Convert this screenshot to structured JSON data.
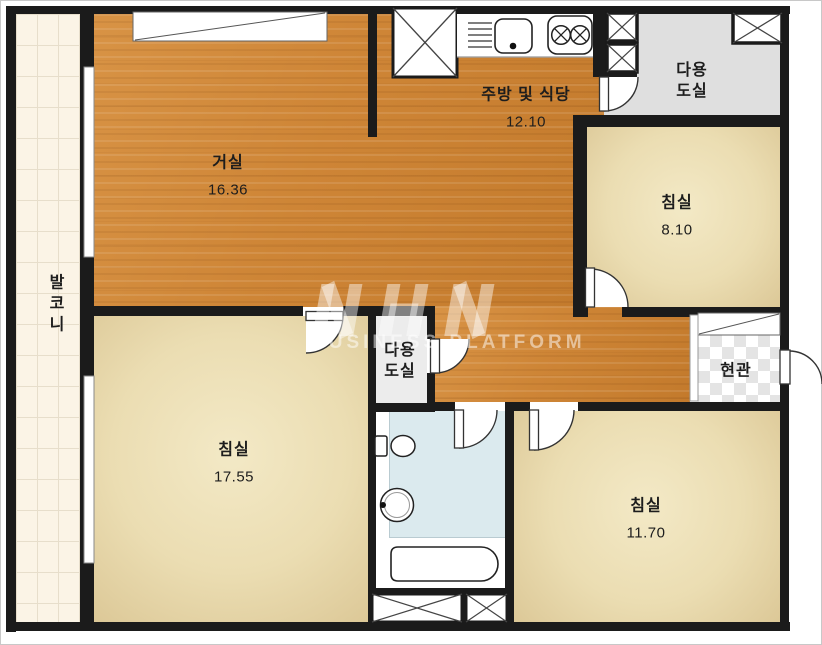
{
  "plan": {
    "type": "apartment-floor-plan",
    "rooms": {
      "living": {
        "name": "거실",
        "area": "16.36"
      },
      "kitchen": {
        "name": "주방 및 식당",
        "area": "12.10"
      },
      "utility_top": {
        "name": "다용\n도실"
      },
      "bedroom_right": {
        "name": "침실",
        "area": "8.10"
      },
      "entrance": {
        "name": "현관"
      },
      "utility_mid": {
        "name": "다용\n도실"
      },
      "bedroom_left": {
        "name": "침실",
        "area": "17.55"
      },
      "bedroom_bottom": {
        "name": "침실",
        "area": "11.70"
      },
      "balcony": {
        "name": "발코니"
      }
    },
    "colors": {
      "wall": "#1B1B1B",
      "wood_floor": "#CE8536",
      "bedroom_floor": "#EBDDB2",
      "balcony_floor": "#FBF4E6",
      "utility_floor": "#DFDFDF",
      "bathroom_floor": "#DBEAEE",
      "entrance_checker": "#E4E4E4"
    }
  },
  "watermark": {
    "logo": "NHN",
    "text": "BUSINESS PLATFORM"
  }
}
